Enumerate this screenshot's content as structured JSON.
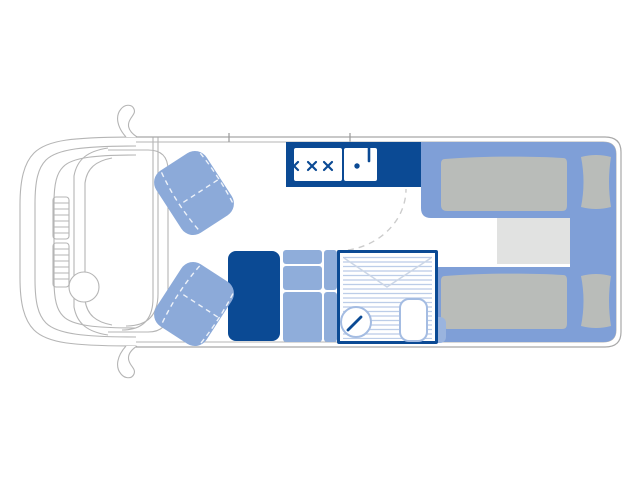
{
  "figure": {
    "kind": "motorhome-floorplan-top-view"
  },
  "palette": {
    "white": "#ffffff",
    "dark_blue": "#0b4a94",
    "bed_blue": "#7f9fd7",
    "seat_blue": "#8caad9",
    "cabinet_blue": "#8fadda",
    "tab_blue": "#9ab4de",
    "stripe_blue": "#bccde8",
    "fixture_blue": "#a4bce2",
    "envelope_gray": "#ccd6e6",
    "mattress_gray": "#b9bcb9",
    "step_gray": "#e1e2e1",
    "line_gray": "#b5b5b5",
    "wall_gray": "#a8a8a8",
    "tick_gray": "#9a9a9a",
    "dash_gray": "#cccccc",
    "seam_white": "#ffffff"
  },
  "items": {
    "cab": "driver-cab",
    "seat_front_left": "swivel-seat",
    "seat_front_right": "swivel-seat",
    "kitchen": "hob-and-sink-unit",
    "wardrobe": "wardrobe-block",
    "fridge": "fridge-unit",
    "cabinet": "kitchen-cabinet-drawers",
    "bathroom": "shower-room-with-basin-and-toilet",
    "bed_top": "single-bed",
    "bed_bottom": "single-bed",
    "step": "center-step"
  }
}
